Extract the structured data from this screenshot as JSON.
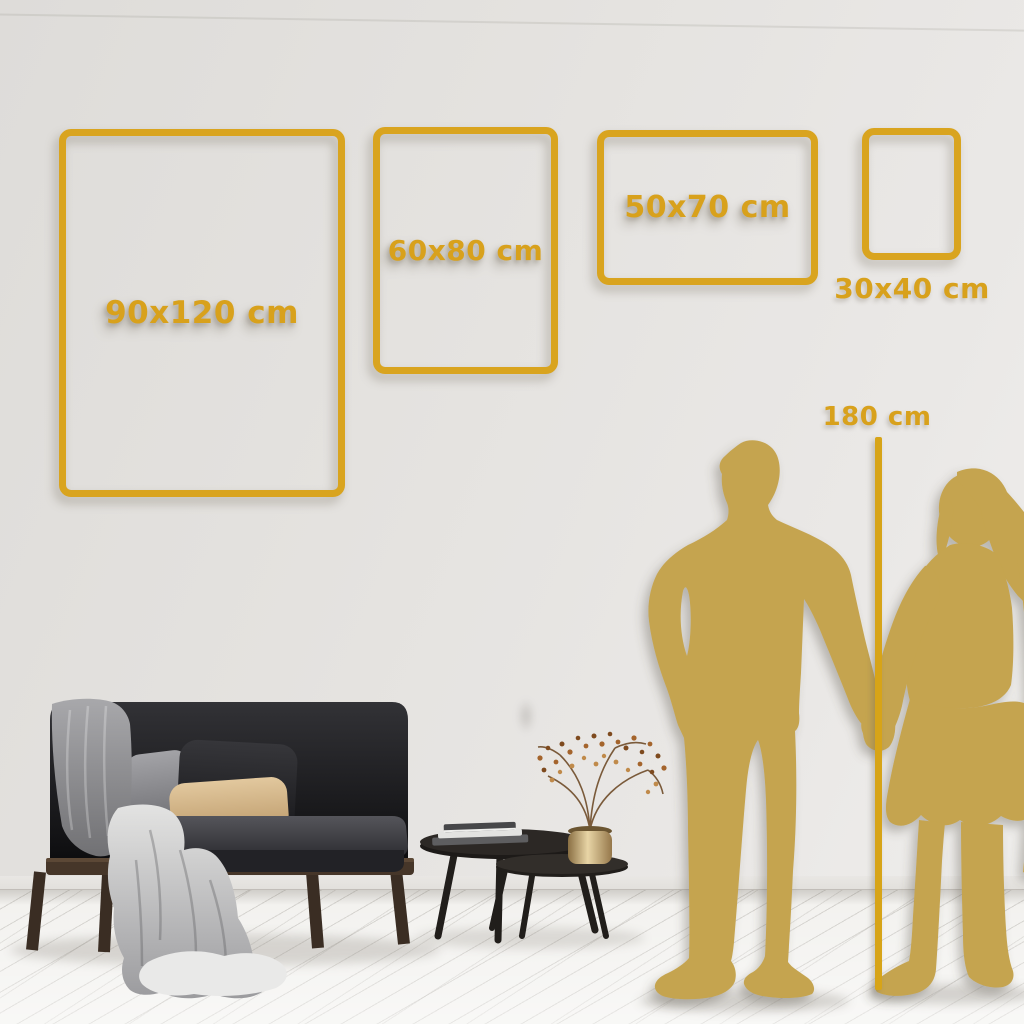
{
  "size_guide": {
    "frames": [
      {
        "id": "90x120",
        "label": "90x120 cm",
        "orientation": "portrait"
      },
      {
        "id": "60x80",
        "label": "60x80 cm",
        "orientation": "portrait"
      },
      {
        "id": "50x70",
        "label": "50x70 cm",
        "orientation": "landscape"
      },
      {
        "id": "30x40",
        "label": "30x40 cm",
        "orientation": "portrait",
        "label_placement": "below-frame"
      }
    ],
    "height_reference": {
      "label": "180 cm",
      "type": "vertical-ruler-line"
    }
  },
  "scene": {
    "setting": "living-room wall mockup",
    "elements": [
      "dark-sofa",
      "throw-blanket",
      "cushions",
      "nesting-coffee-tables",
      "book-stack",
      "brass-vase",
      "dried-branch-with-berries",
      "couple-silhouette-holding-hands",
      "white-wood-plank-floor"
    ]
  },
  "colors": {
    "accent_gold": "#D9A41F",
    "silhouette_gold": "#C5A44F",
    "wall": "#E4E2DF",
    "floor": "#F2F1EE"
  }
}
